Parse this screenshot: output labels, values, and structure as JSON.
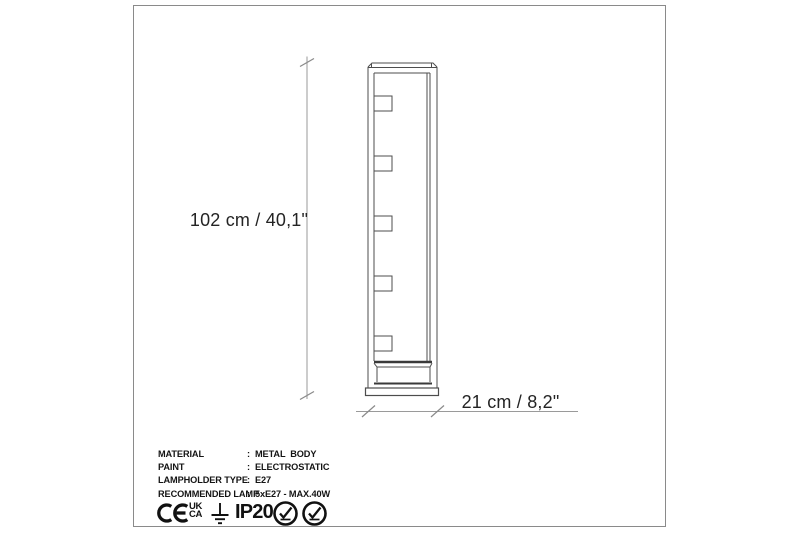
{
  "page": {
    "type": "product-dimension-diagram",
    "colors": {
      "background": "#ffffff",
      "frame_border": "#8a8a8a",
      "drawing_line": "#4d4d4d",
      "drawing_dark_line": "#3a3a3a",
      "dimension_line": "#9a9a9a",
      "text_primary": "#141414"
    }
  },
  "drawing": {
    "product": "floor-lamp-side-view",
    "lampholder_count": 5,
    "height_label": "102 cm / 40,1\"",
    "width_label": "21 cm / 8,2\""
  },
  "specs": {
    "colon": ":",
    "rows": [
      {
        "label": "MATERIAL",
        "value": "METAL  BODY"
      },
      {
        "label": "PAINT",
        "value": "ELECTROSTATIC"
      },
      {
        "label": "LAMPHOLDER TYPE",
        "value": "E27"
      },
      {
        "label": "RECOMMENDED LAMP",
        "value": "5xE27 - MAX.40W"
      }
    ]
  },
  "certifications": {
    "ce_mark": "CE",
    "ukca_line1": "UK",
    "ukca_line2": "CA",
    "earth_symbol": "protective-earth-ground",
    "ip_rating": "IP20",
    "badges": [
      "check-badge",
      "check-badge"
    ]
  }
}
